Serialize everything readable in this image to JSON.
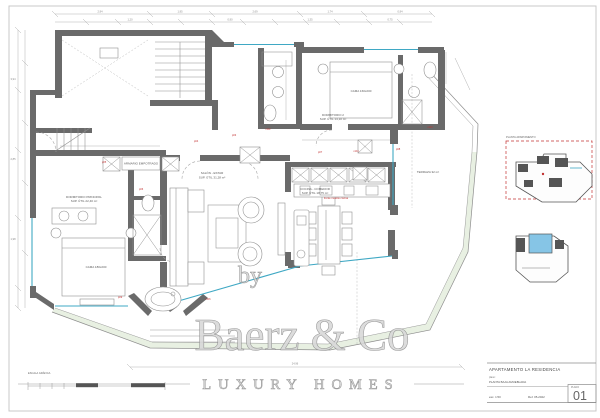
{
  "watermark": {
    "by": "by",
    "brand": "Baerz & Co",
    "tagline": "LUXURY HOMES"
  },
  "title_block": {
    "project": "APARTAMENTO  LA RESIDENCIA",
    "doc_label": "plano:",
    "subtitle": "PLANTA BAJA AMUEBLADA",
    "scale": "esc. 1:50",
    "reference": "Ref. 05-2022",
    "sheet_label": "PLANO",
    "sheet_number": "01"
  },
  "key_plans": {
    "caption": "PLANTA APARTAMENTO"
  },
  "scale_bar": {
    "label": "ESCALA GRÁFICA"
  },
  "plan": {
    "colors": {
      "wall": "#6a6a6a",
      "glazing": "#3fa8c4",
      "red": "#c23232",
      "green": "#e2ecdb",
      "pool": "#86c5e6",
      "frame": "#c9c9c9"
    },
    "labels": [
      {
        "x": 84,
        "y": 198,
        "text": "DORMITORIO PRINCIPAL",
        "s": 2.8
      },
      {
        "x": 84,
        "y": 202,
        "text": "SUP. ÚTIL 22,40 m²",
        "s": 2.3
      },
      {
        "x": 96,
        "y": 268,
        "text": "CAMA 180x200",
        "s": 2.3
      },
      {
        "x": 141,
        "y": 164.6,
        "text": "ARMARIO EMPOTRADO",
        "s": 2.1
      },
      {
        "x": 212,
        "y": 174,
        "text": "SALÓN - ESTAR",
        "s": 3
      },
      {
        "x": 212,
        "y": 178.5,
        "text": "SUP. ÚTIL 31,28 m²",
        "s": 2.3
      },
      {
        "x": 315,
        "y": 190,
        "text": "COCINA - COMEDOR",
        "s": 2.7
      },
      {
        "x": 315,
        "y": 194,
        "text": "SUP. ÚTIL 18,75 m²",
        "s": 2.3
      },
      {
        "x": 361,
        "y": 92,
        "text": "CAMA 160x200",
        "s": 2.3
      },
      {
        "x": 333,
        "y": 116,
        "text": "DORMITORIO 2",
        "s": 2.7
      },
      {
        "x": 333,
        "y": 120,
        "text": "SUP. ÚTIL 14,10 m²",
        "s": 2.3
      },
      {
        "x": 428,
        "y": 173,
        "text": "TERRAZA 32 m²",
        "s": 3
      }
    ],
    "red_tags": [
      {
        "x": 104,
        "y": 163,
        "text": "p05"
      },
      {
        "x": 141,
        "y": 190,
        "text": "p06"
      },
      {
        "x": 196,
        "y": 142,
        "text": "p04"
      },
      {
        "x": 234,
        "y": 136,
        "text": "p03"
      },
      {
        "x": 268,
        "y": 130,
        "text": "m02"
      },
      {
        "x": 320,
        "y": 153,
        "text": "p07"
      },
      {
        "x": 356,
        "y": 152,
        "text": "m04"
      },
      {
        "x": 398,
        "y": 150,
        "text": "p08"
      },
      {
        "x": 430,
        "y": 128,
        "text": "m03"
      },
      {
        "x": 120,
        "y": 298,
        "text": "p09"
      },
      {
        "x": 208,
        "y": 300,
        "text": "m06"
      },
      {
        "x": 336,
        "y": 199,
        "text": "frente mueble cocina"
      }
    ],
    "dim_labels": [
      {
        "x": 100,
        "y": 12.6,
        "text": "2,94"
      },
      {
        "x": 180,
        "y": 12.6,
        "text": "1,95"
      },
      {
        "x": 255,
        "y": 12.6,
        "text": "2,69"
      },
      {
        "x": 330,
        "y": 12.6,
        "text": "1,74"
      },
      {
        "x": 400,
        "y": 12.6,
        "text": "0,94"
      },
      {
        "x": 130,
        "y": 20.6,
        "text": "1,20"
      },
      {
        "x": 230,
        "y": 20.6,
        "text": "0,90"
      },
      {
        "x": 310,
        "y": 20.6,
        "text": "1,35"
      },
      {
        "x": 390,
        "y": 20.6,
        "text": "0,75"
      },
      {
        "x": 13,
        "y": 80,
        "text": "3,94"
      },
      {
        "x": 13,
        "y": 160,
        "text": "2,85"
      },
      {
        "x": 13,
        "y": 240,
        "text": "1,98"
      },
      {
        "x": 295,
        "y": 364.6,
        "text": "24,96"
      }
    ]
  }
}
